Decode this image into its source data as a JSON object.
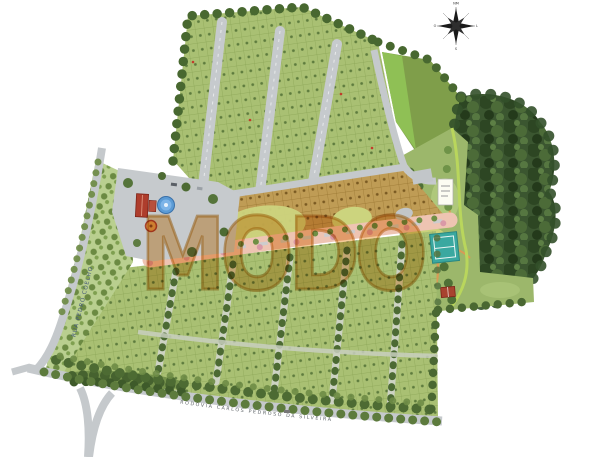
{
  "watermark": {
    "text": "MODO",
    "fill": "#E79738",
    "stroke": "#C27A1E"
  },
  "compass": {
    "north": "NM",
    "east": "L",
    "south": "S",
    "west": "O"
  },
  "streets": {
    "bottom_road": "RODOVIA CARLOS PEDROSO DA SILVEIRA",
    "left_road": "RUA PEDRO COELHO"
  },
  "colors": {
    "background": "#FFFFFF",
    "plot_green": "#A9C073",
    "plot_grid": "#8AA455",
    "plot_tan": "#BF9C55",
    "tan_grid": "#97742F",
    "forest": "#3B5630",
    "tree_border": "#486830",
    "meadow": "#7F9E4A",
    "meadow_light": "#8FC055",
    "garden_lawn": "#9CB76B",
    "orchard": "#B9CF8F",
    "road": "#C5C9CC",
    "plaza": "#C6CACD",
    "pink_avenue": "#EEC4B2",
    "field_yellow": "#CCD47E",
    "water": "#5B9BD5",
    "court": "#3AA8A0",
    "roof_red": "#AE3D2C",
    "trail_orange": "#D99A55"
  }
}
